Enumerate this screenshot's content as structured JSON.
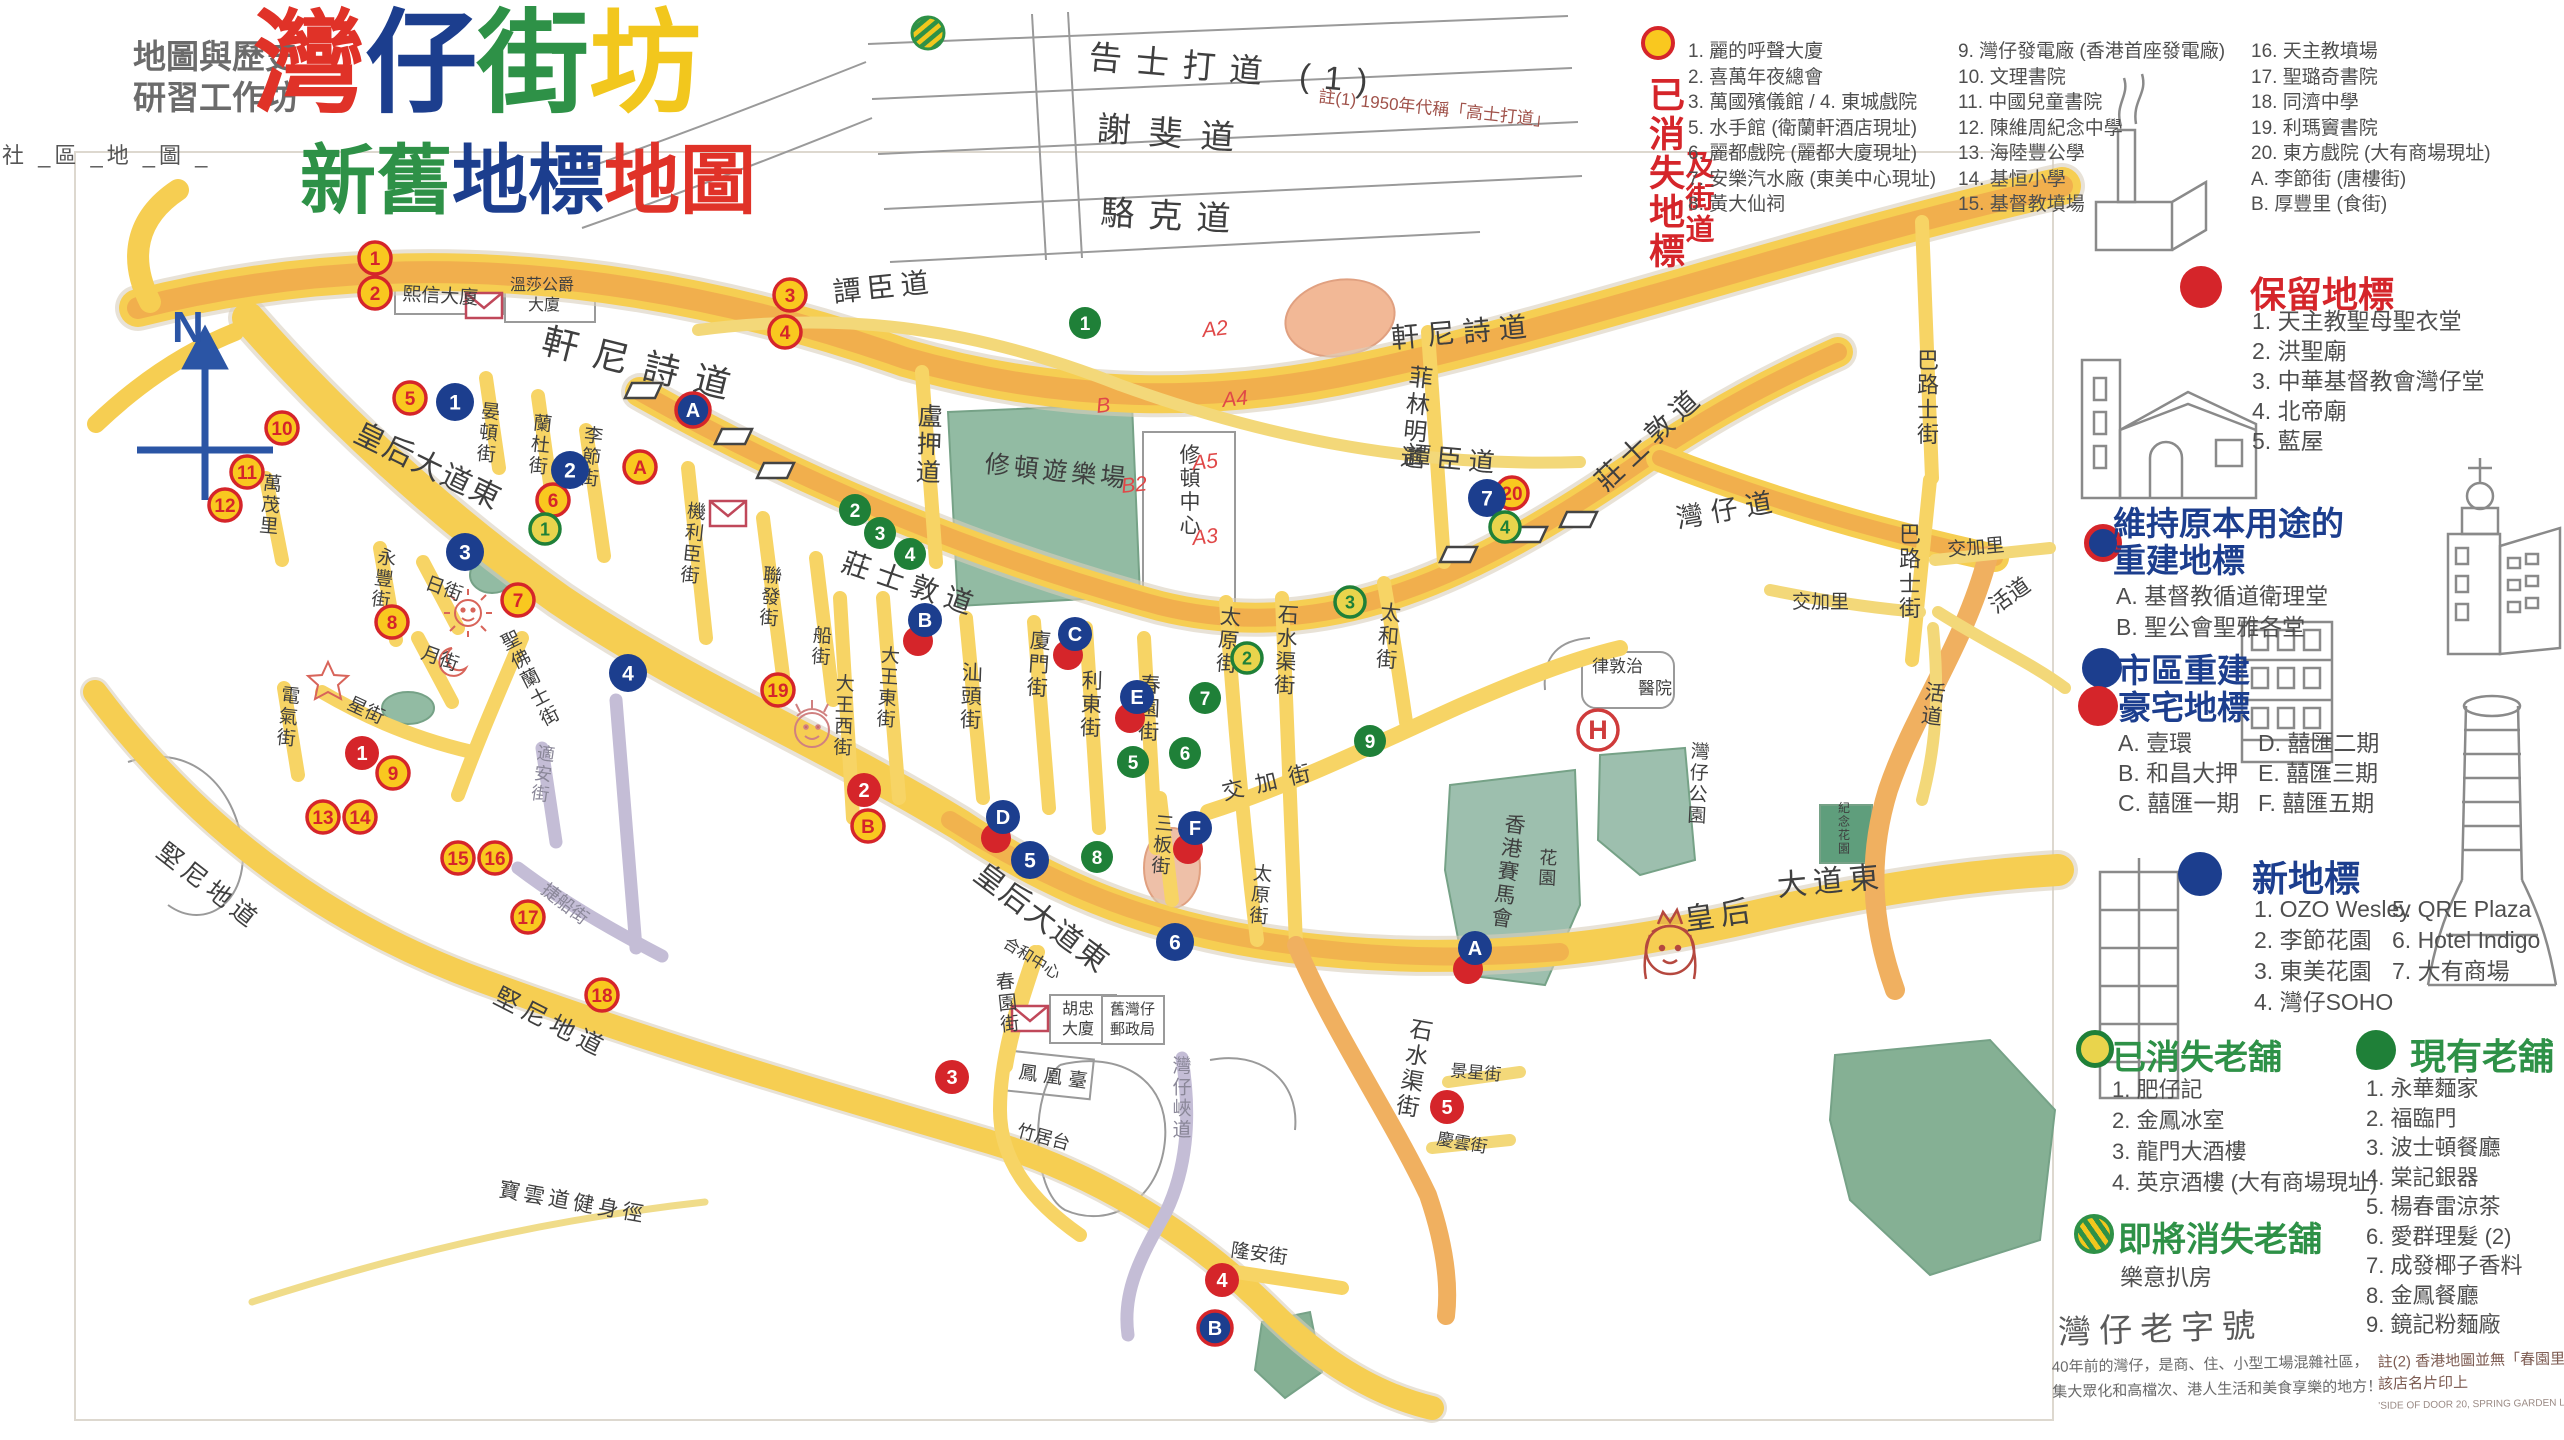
{
  "header": {
    "workshop_line1": "地圖與歷史",
    "workshop_line2": "研習工作坊",
    "side_label": "社 _區 _地 _圖 _",
    "title_chars": [
      {
        "ch": "灣",
        "c": "#e03228"
      },
      {
        "ch": "仔",
        "c": "#1c3e8e"
      },
      {
        "ch": "街",
        "c": "#2e9147"
      },
      {
        "ch": "坊",
        "c": "#f2c71d"
      }
    ],
    "subtitle_chars": [
      {
        "ch": "新",
        "c": "#2e9147"
      },
      {
        "ch": "舊",
        "c": "#2e9147"
      },
      {
        "ch": "地",
        "c": "#1c3e8e"
      },
      {
        "ch": "標",
        "c": "#1c3e8e"
      },
      {
        "ch": "地",
        "c": "#e03228"
      },
      {
        "ch": "圖",
        "c": "#e03228"
      }
    ]
  },
  "legend_lost": {
    "title_col1": "已消失地標",
    "title_col2": "及街道",
    "col1": [
      "1. 麗的呼聲大廈",
      "2. 喜萬年夜總會",
      "3. 萬國殯儀館 / 4. 東城戲院",
      "5. 水手館 (衛蘭軒酒店現址)",
      "6. 麗都戲院 (麗都大廈現址)",
      "7. 安樂汽水廠 (東美中心現址)",
      "8. 黃大仙祠"
    ],
    "col2": [
      "9. 灣仔發電廠 (香港首座發電廠)",
      "10. 文理書院",
      "11. 中國兒童書院",
      "12. 陳維周紀念中學",
      "13. 海陸豐公學",
      "14. 基恒小學",
      "15. 基督教墳場"
    ],
    "col3": [
      "16. 天主教墳場",
      "17. 聖璐奇書院",
      "18. 同濟中學",
      "19. 利瑪竇書院",
      "20. 東方戲院 (大有商場現址)",
      "A. 李節街 (唐樓街)",
      "B. 厚豐里 (食街)"
    ]
  },
  "sections": {
    "kept": {
      "title": "保留地標",
      "items": [
        "1. 天主教聖母聖衣堂",
        "2. 洪聖廟",
        "3. 中華基督教會灣仔堂",
        "4. 北帝廟",
        "5. 藍屋"
      ]
    },
    "rebuilt": {
      "title_line1": "維持原本用途的",
      "title_line2": "重建地標",
      "items": [
        "A. 基督教循道衛理堂",
        "B. 聖公會聖雅各堂"
      ]
    },
    "luxury": {
      "title_line1": "市區重建",
      "title_line2": "豪宅地標",
      "col1": [
        "A. 壹環",
        "B. 和昌大押",
        "C. 囍匯一期"
      ],
      "col2": [
        "D. 囍匯二期",
        "E. 囍匯三期",
        "F. 囍匯五期"
      ]
    },
    "new_landmarks": {
      "title": "新地標",
      "col1": [
        "1. OZO Wesley",
        "2. 李節花園",
        "3. 東美花園",
        "4. 灣仔SOHO"
      ],
      "col2": [
        "5. QRE Plaza",
        "6. Hotel Indigo",
        "7. 大有商場"
      ]
    },
    "shops_gone": {
      "title": "已消失老舖",
      "items": [
        "1. 肥仔記",
        "2. 金鳳冰室",
        "3. 龍門大酒樓",
        "4. 英京酒樓 (大有商場現址)"
      ]
    },
    "closing": {
      "title": "即將消失老舖",
      "items": [
        "樂意扒房"
      ]
    },
    "shops": {
      "title": "現有老舖",
      "items": [
        "1. 永華麵家",
        "2. 福臨門",
        "3. 波士頓餐廳",
        "4. 棠記銀器",
        "5. 楊春雷涼茶",
        "6. 愛群理髮 (2)",
        "7. 成發椰子香料",
        "8. 金鳳餐廳",
        "9. 鏡記粉麵廠"
      ]
    }
  },
  "footer": {
    "brand_title": "灣仔老字號",
    "brand_line1": "40年前的灣仔，是商、住、小型工場混雜社區，",
    "brand_line2": "集大眾化和高檔次、港人生活和美食享樂的地方！",
    "note2_line1": "註(2) 香港地圖並無「春園里」,",
    "note2_line2": "該店名片印上",
    "note2_line3": "'SIDE OF DOOR 20, SPRING GARDEN LANE'"
  },
  "map": {
    "north_label": "N",
    "hospital_h": "H",
    "street_note": "註(1) 1950年代稱「高士打道」",
    "route_marks": [
      {
        "t": "A2",
        "x": 1203,
        "y": 337
      },
      {
        "t": "A4",
        "x": 1223,
        "y": 407
      },
      {
        "t": "B",
        "x": 1097,
        "y": 413
      },
      {
        "t": "A5",
        "x": 1193,
        "y": 470
      },
      {
        "t": "B2",
        "x": 1122,
        "y": 493
      },
      {
        "t": "A3",
        "x": 1193,
        "y": 545
      }
    ],
    "labels": [
      {
        "t": "軒尼詩道",
        "x": 540,
        "y": 352,
        "s": 36,
        "r": 14,
        "ls": 16
      },
      {
        "t": "軒尼詩道",
        "x": 1392,
        "y": 348,
        "s": 28,
        "r": -5,
        "ls": 8
      },
      {
        "t": "告士打道 (1)",
        "x": 1088,
        "y": 68,
        "s": 33,
        "r": 5,
        "ls": 14
      },
      {
        "t": "謝斐道",
        "x": 1096,
        "y": 140,
        "s": 34,
        "r": 4,
        "ls": 18
      },
      {
        "t": "駱克道",
        "x": 1100,
        "y": 224,
        "s": 34,
        "r": 3,
        "ls": 14
      },
      {
        "t": "譚臣道",
        "x": 834,
        "y": 302,
        "s": 28,
        "r": -6,
        "ls": 6
      },
      {
        "t": "譚臣道",
        "x": 1404,
        "y": 464,
        "s": 26,
        "r": 5,
        "ls": 6
      },
      {
        "t": "盧押道",
        "x": 930,
        "y": 425,
        "s": 25,
        "v": 1,
        "r": 2
      },
      {
        "t": "菲林明道",
        "x": 1420,
        "y": 386,
        "s": 24,
        "v": 1,
        "r": 6
      },
      {
        "t": "莊士敦道",
        "x": 840,
        "y": 570,
        "s": 28,
        "r": 19,
        "ls": 8
      },
      {
        "t": "莊士敦道",
        "x": 1606,
        "y": 492,
        "s": 28,
        "r": -43,
        "ls": 6
      },
      {
        "t": "灣仔道",
        "x": 1678,
        "y": 528,
        "s": 27,
        "r": -10,
        "ls": 8
      },
      {
        "t": "巴路士街",
        "x": 1928,
        "y": 368,
        "s": 22,
        "v": 1
      },
      {
        "t": "巴路士街",
        "x": 1910,
        "y": 542,
        "s": 22,
        "v": 1
      },
      {
        "t": "交加里",
        "x": 1792,
        "y": 608,
        "s": 19
      },
      {
        "t": "交加里",
        "x": 1948,
        "y": 556,
        "s": 19,
        "r": -5
      },
      {
        "t": "活道",
        "x": 1996,
        "y": 614,
        "s": 22,
        "r": -35
      },
      {
        "t": "活道",
        "x": 1934,
        "y": 700,
        "s": 21,
        "v": 1,
        "r": 8
      },
      {
        "t": "皇后大道東",
        "x": 352,
        "y": 440,
        "s": 30,
        "r": 26,
        "ls": 2
      },
      {
        "t": "皇后大道東",
        "x": 972,
        "y": 878,
        "s": 30,
        "r": 37,
        "ls": 2
      },
      {
        "t": "皇后",
        "x": 1686,
        "y": 930,
        "s": 30,
        "r": -8,
        "ls": 6
      },
      {
        "t": "大道東",
        "x": 1778,
        "y": 896,
        "s": 30,
        "r": -5,
        "ls": 6
      },
      {
        "t": "晏頓街",
        "x": 490,
        "y": 418,
        "s": 19,
        "v": 1,
        "r": 6
      },
      {
        "t": "蘭杜街",
        "x": 542,
        "y": 430,
        "s": 19,
        "v": 1,
        "r": 6
      },
      {
        "t": "李節街",
        "x": 593,
        "y": 442,
        "s": 19,
        "v": 1,
        "r": 6
      },
      {
        "t": "機利臣街",
        "x": 696,
        "y": 518,
        "s": 19,
        "v": 1,
        "r": 6
      },
      {
        "t": "聯發街",
        "x": 772,
        "y": 582,
        "s": 19,
        "v": 1,
        "r": 5
      },
      {
        "t": "船街",
        "x": 822,
        "y": 642,
        "s": 19,
        "v": 1,
        "r": 4
      },
      {
        "t": "大王西街",
        "x": 845,
        "y": 690,
        "s": 19,
        "v": 1,
        "r": 2
      },
      {
        "t": "大王東街",
        "x": 890,
        "y": 662,
        "s": 19,
        "v": 1,
        "r": 4
      },
      {
        "t": "汕頭街",
        "x": 972,
        "y": 680,
        "s": 21,
        "v": 1,
        "r": 2
      },
      {
        "t": "廈門街",
        "x": 1040,
        "y": 648,
        "s": 21,
        "v": 1,
        "r": 4
      },
      {
        "t": "利東街",
        "x": 1092,
        "y": 688,
        "s": 21,
        "v": 1,
        "r": 2
      },
      {
        "t": "春園街",
        "x": 1150,
        "y": 692,
        "s": 21,
        "v": 1,
        "r": 2
      },
      {
        "t": "春園街",
        "x": 1006,
        "y": 988,
        "s": 19,
        "v": 1,
        "r": -6
      },
      {
        "t": "三板街",
        "x": 1164,
        "y": 830,
        "s": 19,
        "v": 1,
        "r": 5
      },
      {
        "t": "太原街",
        "x": 1230,
        "y": 624,
        "s": 21,
        "v": 1,
        "r": 5
      },
      {
        "t": "太原街",
        "x": 1262,
        "y": 880,
        "s": 19,
        "v": 1,
        "r": 5
      },
      {
        "t": "石水渠街",
        "x": 1288,
        "y": 622,
        "s": 21,
        "v": 1,
        "r": 3
      },
      {
        "t": "石水渠街",
        "x": 1420,
        "y": 1038,
        "s": 23,
        "v": 1,
        "r": 10
      },
      {
        "t": "太和街",
        "x": 1390,
        "y": 620,
        "s": 21,
        "v": 1,
        "r": 5
      },
      {
        "t": "交加街",
        "x": 1224,
        "y": 800,
        "s": 22,
        "r": -13,
        "ls": 12
      },
      {
        "t": "永豐街",
        "x": 386,
        "y": 564,
        "s": 19,
        "v": 1,
        "r": 8
      },
      {
        "t": "萬茂里",
        "x": 272,
        "y": 490,
        "s": 19,
        "v": 1,
        "r": 5
      },
      {
        "t": "日街",
        "x": 424,
        "y": 588,
        "s": 19,
        "r": 20
      },
      {
        "t": "月街",
        "x": 420,
        "y": 658,
        "s": 19,
        "r": 20
      },
      {
        "t": "星街",
        "x": 346,
        "y": 708,
        "s": 19,
        "r": 25
      },
      {
        "t": "電氣街",
        "x": 290,
        "y": 702,
        "s": 19,
        "v": 1,
        "r": 6
      },
      {
        "t": "聖佛蘭士街",
        "x": 514,
        "y": 646,
        "s": 19,
        "v": 1,
        "r": -27
      },
      {
        "t": "堅尼地道",
        "x": 155,
        "y": 855,
        "s": 25,
        "r": 38,
        "ls": 6
      },
      {
        "t": "堅尼地道",
        "x": 492,
        "y": 1002,
        "s": 25,
        "r": 27,
        "ls": 6
      },
      {
        "t": "適安街",
        "x": 545,
        "y": 760,
        "s": 18,
        "v": 1,
        "r": 8,
        "c": "#8a8798"
      },
      {
        "t": "捷船街",
        "x": 540,
        "y": 892,
        "s": 18,
        "r": 38,
        "c": "#8a8798"
      },
      {
        "t": "灣仔峽道",
        "x": 1182,
        "y": 1072,
        "s": 19,
        "v": 1,
        "c": "#8a8798"
      },
      {
        "t": "隆安街",
        "x": 1230,
        "y": 1256,
        "s": 19,
        "r": 8
      },
      {
        "t": "景星街",
        "x": 1450,
        "y": 1076,
        "s": 17,
        "r": 5
      },
      {
        "t": "慶雲街",
        "x": 1436,
        "y": 1144,
        "s": 17,
        "r": 10
      },
      {
        "t": "灣仔公園",
        "x": 1700,
        "y": 758,
        "s": 19,
        "v": 1,
        "r": 3
      },
      {
        "t": "香港賽馬會",
        "x": 1514,
        "y": 832,
        "s": 21,
        "v": 1,
        "r": 8
      },
      {
        "t": "花園",
        "x": 1548,
        "y": 864,
        "s": 18,
        "v": 1,
        "r": 3
      },
      {
        "t": "紀念花園",
        "x": 1844,
        "y": 812,
        "s": 12,
        "v": 1
      },
      {
        "t": "律敦治",
        "x": 1592,
        "y": 672,
        "s": 17
      },
      {
        "t": "醫院",
        "x": 1638,
        "y": 694,
        "s": 17
      },
      {
        "t": "修頓遊樂場",
        "x": 984,
        "y": 472,
        "s": 25,
        "r": 6,
        "ls": 4
      },
      {
        "t": "修頓中心",
        "x": 1190,
        "y": 462,
        "s": 21,
        "v": 1
      },
      {
        "t": "熙信大廈",
        "x": 402,
        "y": 300,
        "s": 19,
        "r": 3
      },
      {
        "t": "溫莎公爵",
        "x": 510,
        "y": 290,
        "s": 16
      },
      {
        "t": "大廈",
        "x": 528,
        "y": 310,
        "s": 16
      },
      {
        "t": "合和中心",
        "x": 1002,
        "y": 946,
        "s": 16,
        "r": 32
      },
      {
        "t": "胡忠",
        "x": 1062,
        "y": 1014,
        "s": 16
      },
      {
        "t": "大廈",
        "x": 1062,
        "y": 1034,
        "s": 16
      },
      {
        "t": "舊灣仔",
        "x": 1110,
        "y": 1014,
        "s": 15
      },
      {
        "t": "郵政局",
        "x": 1110,
        "y": 1034,
        "s": 15
      },
      {
        "t": "鳳凰臺",
        "x": 1018,
        "y": 1078,
        "s": 19,
        "r": 8,
        "ls": 6
      },
      {
        "t": "竹居台",
        "x": 1016,
        "y": 1136,
        "s": 18,
        "r": 15
      },
      {
        "t": "寶雲道健身徑",
        "x": 498,
        "y": 1196,
        "s": 21,
        "r": 10,
        "ls": 4
      }
    ],
    "markers": [
      {
        "t": "lost",
        "l": "1",
        "x": 375,
        "y": 258
      },
      {
        "t": "lost",
        "l": "2",
        "x": 375,
        "y": 293
      },
      {
        "t": "lost",
        "l": "3",
        "x": 790,
        "y": 295
      },
      {
        "t": "lost",
        "l": "4",
        "x": 785,
        "y": 332
      },
      {
        "t": "lost",
        "l": "5",
        "x": 410,
        "y": 398
      },
      {
        "t": "lost",
        "l": "6",
        "x": 553,
        "y": 500
      },
      {
        "t": "lost",
        "l": "7",
        "x": 518,
        "y": 600
      },
      {
        "t": "lost",
        "l": "8",
        "x": 392,
        "y": 622
      },
      {
        "t": "lost",
        "l": "9",
        "x": 393,
        "y": 773
      },
      {
        "t": "lost",
        "l": "10",
        "x": 282,
        "y": 428
      },
      {
        "t": "lost",
        "l": "11",
        "x": 247,
        "y": 472
      },
      {
        "t": "lost",
        "l": "12",
        "x": 225,
        "y": 505
      },
      {
        "t": "lost",
        "l": "13",
        "x": 323,
        "y": 817
      },
      {
        "t": "lost",
        "l": "14",
        "x": 360,
        "y": 817
      },
      {
        "t": "lost",
        "l": "15",
        "x": 458,
        "y": 858
      },
      {
        "t": "lost",
        "l": "16",
        "x": 495,
        "y": 858
      },
      {
        "t": "lost",
        "l": "17",
        "x": 528,
        "y": 917
      },
      {
        "t": "lost",
        "l": "18",
        "x": 602,
        "y": 995
      },
      {
        "t": "lost",
        "l": "19",
        "x": 778,
        "y": 690
      },
      {
        "t": "lost",
        "l": "20",
        "x": 1512,
        "y": 493
      },
      {
        "t": "lost",
        "l": "A",
        "x": 640,
        "y": 467
      },
      {
        "t": "lost",
        "l": "B",
        "x": 868,
        "y": 826
      },
      {
        "t": "kept",
        "l": "1",
        "x": 362,
        "y": 753
      },
      {
        "t": "kept",
        "l": "2",
        "x": 864,
        "y": 790
      },
      {
        "t": "kept",
        "l": "3",
        "x": 952,
        "y": 1077
      },
      {
        "t": "kept",
        "l": "4",
        "x": 1222,
        "y": 1280
      },
      {
        "t": "kept",
        "l": "5",
        "x": 1447,
        "y": 1107
      },
      {
        "t": "rebuilt",
        "l": "A",
        "x": 693,
        "y": 410
      },
      {
        "t": "rebuilt",
        "l": "B",
        "x": 1215,
        "y": 1328
      },
      {
        "t": "luxury",
        "l": "A",
        "x": 1475,
        "y": 948
      },
      {
        "t": "luxury",
        "l": "B",
        "x": 925,
        "y": 620
      },
      {
        "t": "luxury",
        "l": "C",
        "x": 1075,
        "y": 634
      },
      {
        "t": "luxury",
        "l": "D",
        "x": 1003,
        "y": 817
      },
      {
        "t": "luxury",
        "l": "E",
        "x": 1137,
        "y": 697
      },
      {
        "t": "luxury",
        "l": "F",
        "x": 1195,
        "y": 828
      },
      {
        "t": "new",
        "l": "1",
        "x": 455,
        "y": 402
      },
      {
        "t": "new",
        "l": "2",
        "x": 570,
        "y": 470
      },
      {
        "t": "new",
        "l": "3",
        "x": 465,
        "y": 552
      },
      {
        "t": "new",
        "l": "4",
        "x": 628,
        "y": 673
      },
      {
        "t": "new",
        "l": "5",
        "x": 1030,
        "y": 860
      },
      {
        "t": "new",
        "l": "6",
        "x": 1175,
        "y": 942
      },
      {
        "t": "new",
        "l": "7",
        "x": 1487,
        "y": 498
      },
      {
        "t": "shopgone",
        "l": "1",
        "x": 545,
        "y": 529
      },
      {
        "t": "shopgone",
        "l": "2",
        "x": 1247,
        "y": 658
      },
      {
        "t": "shopgone",
        "l": "3",
        "x": 1350,
        "y": 602
      },
      {
        "t": "shopgone",
        "l": "4",
        "x": 1505,
        "y": 527
      },
      {
        "t": "shop",
        "l": "1",
        "x": 1085,
        "y": 323
      },
      {
        "t": "shop",
        "l": "2",
        "x": 855,
        "y": 510
      },
      {
        "t": "shop",
        "l": "3",
        "x": 880,
        "y": 533
      },
      {
        "t": "shop",
        "l": "4",
        "x": 910,
        "y": 554
      },
      {
        "t": "shop",
        "l": "5",
        "x": 1133,
        "y": 762
      },
      {
        "t": "shop",
        "l": "6",
        "x": 1185,
        "y": 753
      },
      {
        "t": "shop",
        "l": "7",
        "x": 1205,
        "y": 698
      },
      {
        "t": "shop",
        "l": "8",
        "x": 1097,
        "y": 857
      },
      {
        "t": "shop",
        "l": "9",
        "x": 1370,
        "y": 741
      },
      {
        "t": "closing",
        "l": "",
        "x": 928,
        "y": 33
      }
    ]
  }
}
